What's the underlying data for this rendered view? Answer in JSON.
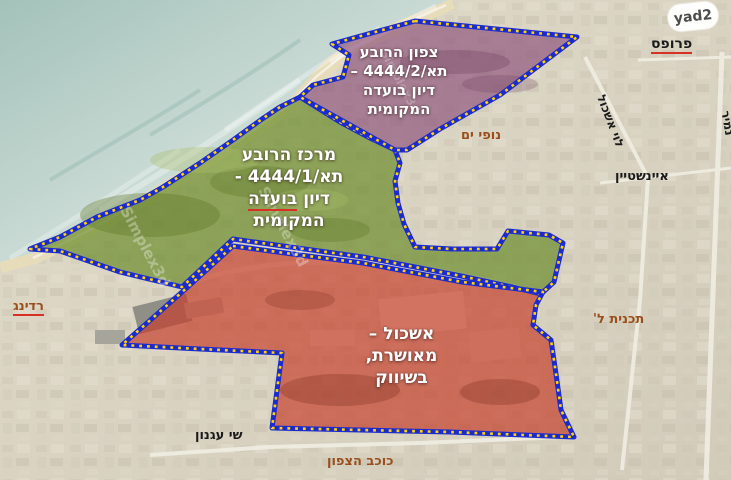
{
  "logo": {
    "text": "yad2"
  },
  "regions": {
    "purple": {
      "lines": [
        "צפון הרובע",
        "תא/4444/2 –",
        "דיון בועדה",
        "המקומית"
      ]
    },
    "green": {
      "line1": "מרכז הרובע",
      "line2": "תא/4444/1 -",
      "line3a": "דיון",
      "line3b": "בועדה",
      "line4": "המקומית"
    },
    "red": {
      "lines": [
        "אשכול –",
        "מאושרת,",
        "בשיווק"
      ]
    }
  },
  "map_labels": {
    "profes": "פרופס",
    "nofei_yam": "נופי ים",
    "levi_eshkol": "לוי אשכול",
    "namir": "נמיר",
    "einstein": "איינשטיין",
    "tochnit_l": "תכנית ל'",
    "reading": "רדינג",
    "shai_agnon": "שי עגנון",
    "kochav_hatzafon": "כוכב הצפון"
  },
  "watermark": {
    "text": "Simplex3d"
  },
  "colors": {
    "border_blue": "#1c2bd0",
    "dash_yellow": "#ffd400",
    "purple_fill": "#8a4f78",
    "green_fill": "#6f8f2f",
    "red_fill": "#c63c2a",
    "sea": "#a3c2ba",
    "sand": "#e7dcba",
    "land": "#d8d1c1",
    "label_brown": "#9a4e1b",
    "label_black": "#1b1b1b",
    "misspell_red": "#d93025"
  }
}
